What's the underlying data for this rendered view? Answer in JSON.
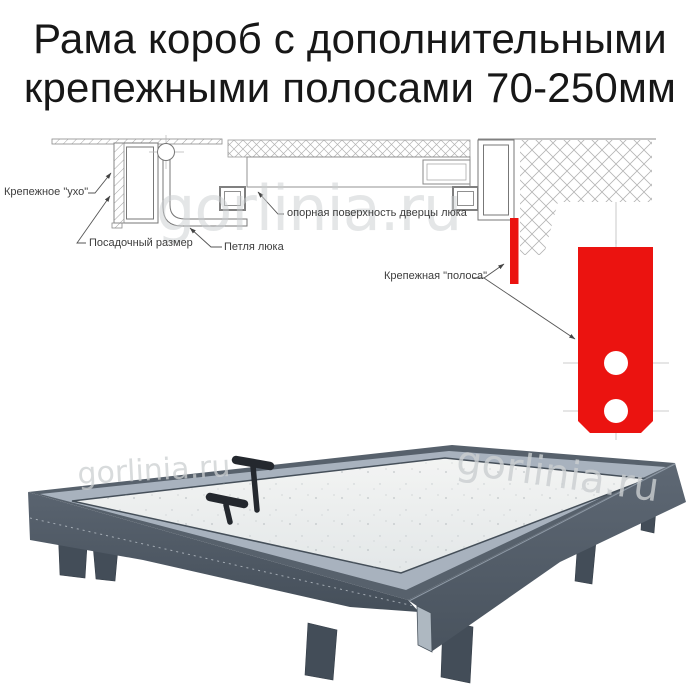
{
  "title": {
    "line1": "Рама короб с дополнительными",
    "line2": "крепежными полосами 70-250мм"
  },
  "watermark": {
    "text": "gorlinia.ru",
    "color": "#cbcfd1"
  },
  "diagram": {
    "labels": {
      "ear": "Крепежное \"ухо\"",
      "mounting_size": "Посадочный размер",
      "hatch_hinge": "Петля люка",
      "support_surface": "опорная поверхность дверцы люка",
      "fastening_strip": "Крепежная \"полоса\""
    },
    "colors": {
      "strip_red": "#eb1310",
      "line": "#6e6e6e",
      "hatch": "#adadad"
    }
  },
  "photo": {
    "colors": {
      "frame_side": "#4d5762",
      "frame_flange": "#a8b2be",
      "panel": "#edefef",
      "legs": "#434d58",
      "handles": "#24282e"
    }
  }
}
